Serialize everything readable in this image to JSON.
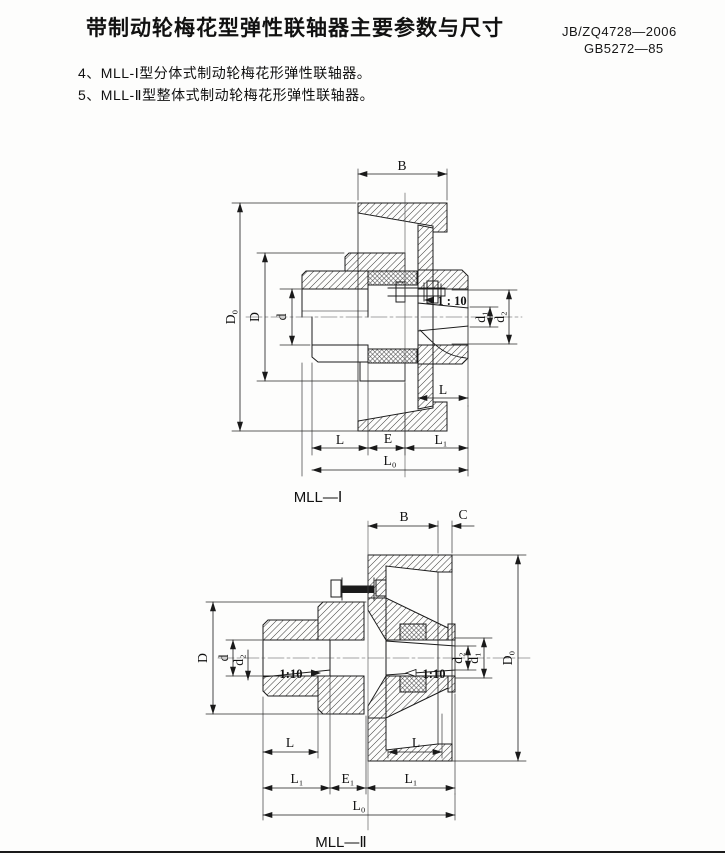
{
  "header": {
    "title": "带制动轮梅花型弹性联轴器主要参数与尺寸",
    "standard_1": "JB/ZQ4728—2006",
    "standard_2": "GB5272—85"
  },
  "notes": {
    "item_4": "4、MLL-Ⅰ型分体式制动轮梅花形弹性联轴器。",
    "item_5": "5、MLL-Ⅱ型整体式制动轮梅花形弹性联轴器。"
  },
  "d1": {
    "caption": "MLL—Ⅰ",
    "labels": {
      "B": "B",
      "D0": "D₀",
      "D": "D",
      "d": "d",
      "taper": "1 : 10",
      "d1": "d₁",
      "d2": "d₂",
      "L_right": "L",
      "L_bottom": "L",
      "E": "E",
      "L1": "L₁",
      "L0": "L₀"
    }
  },
  "d2": {
    "caption": "MLL—Ⅱ",
    "labels": {
      "B": "B",
      "C": "C",
      "D": "D",
      "d": "d",
      "d2_left": "d₂",
      "taper_left": "1:10",
      "taper_right": "1:10",
      "d2_right": "d₂",
      "d1": "d₁",
      "D0": "D₀",
      "L_left": "L",
      "L_right": "L",
      "L1_left": "L₁",
      "E1": "E₁",
      "L1_right": "L₁",
      "L0": "L₀"
    }
  }
}
